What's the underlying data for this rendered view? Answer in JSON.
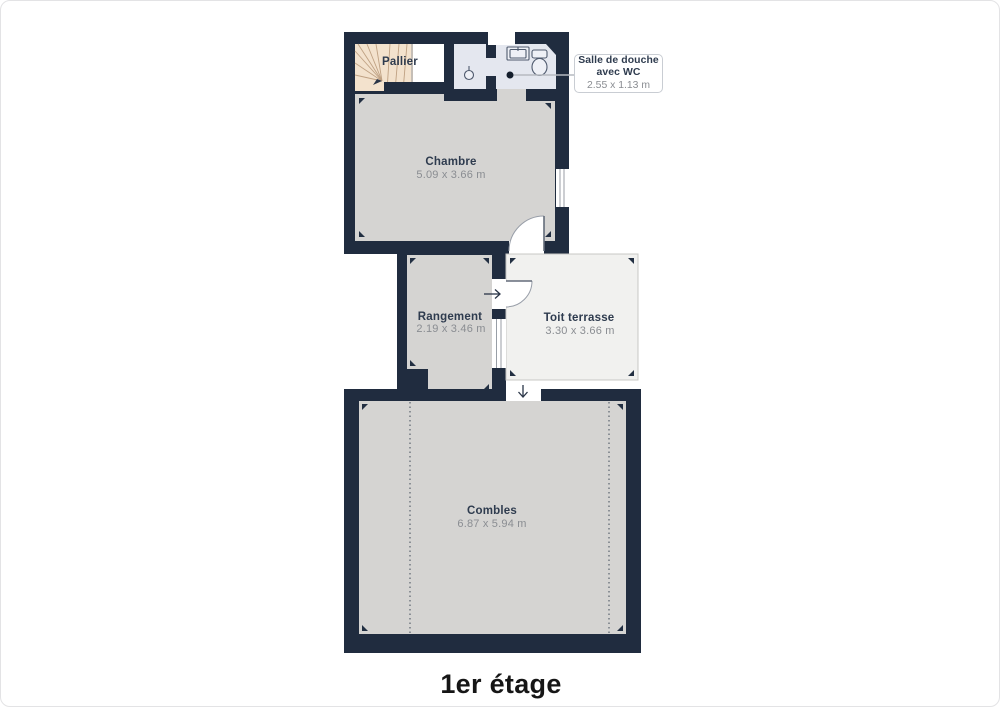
{
  "floor_plan": {
    "title": "1er étage",
    "rooms": {
      "pallier": {
        "name": "Pallier"
      },
      "chambre": {
        "name": "Chambre",
        "dims": "5.09 x 3.66 m"
      },
      "douche": {
        "line1": "Salle de douche",
        "line2": "avec WC",
        "dims": "2.55 x 1.13 m"
      },
      "rangement": {
        "name": "Rangement",
        "dims": "2.19 x 3.46 m"
      },
      "terrasse": {
        "name": "Toit terrasse",
        "dims": "3.30 x 3.66 m"
      },
      "combles": {
        "name": "Combles",
        "dims": "6.87 x 5.94 m"
      }
    },
    "colors": {
      "wall": "#202c3f",
      "floor": "#d5d4d2",
      "stairs": "#f3e2cd",
      "shower_floor": "#e4e7ef",
      "terrace_floor": "#f1f1ef",
      "room_label": "#2e3b4e",
      "dimension_label": "#8a8d92",
      "title": "#161616"
    }
  }
}
